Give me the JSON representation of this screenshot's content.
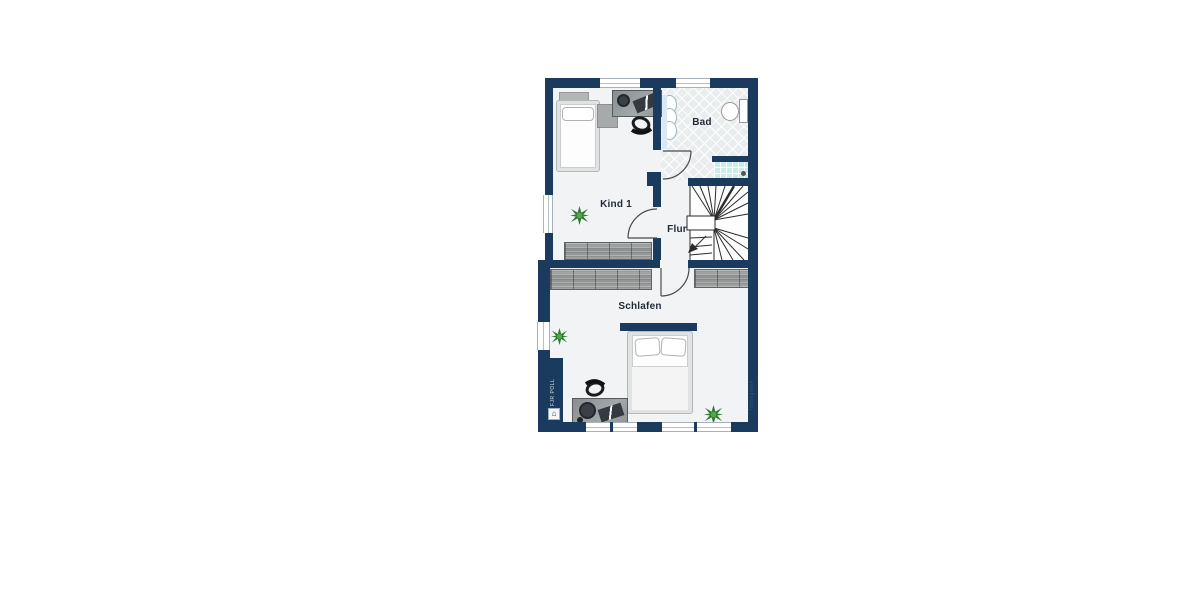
{
  "floorplan": {
    "rooms": [
      {
        "id": "bad",
        "label": "Bad"
      },
      {
        "id": "kind1",
        "label": "Kind 1"
      },
      {
        "id": "flur",
        "label": "Flur"
      },
      {
        "id": "schlafen",
        "label": "Schlafen"
      }
    ],
    "watermarks": {
      "left_text": "FJR POLL",
      "right_text": "Immografik",
      "left_logo_glyph": "⌂"
    },
    "colors": {
      "wall_navy": "#1a3a5e",
      "floor_light": "#f2f3f5",
      "bath_tile": "#eaedee",
      "shower_tile": "#cdece8",
      "wardrobe_gray": "#9a9d9d",
      "desk_gray": "#8d9496",
      "plant_green": "#2f7a33"
    }
  }
}
